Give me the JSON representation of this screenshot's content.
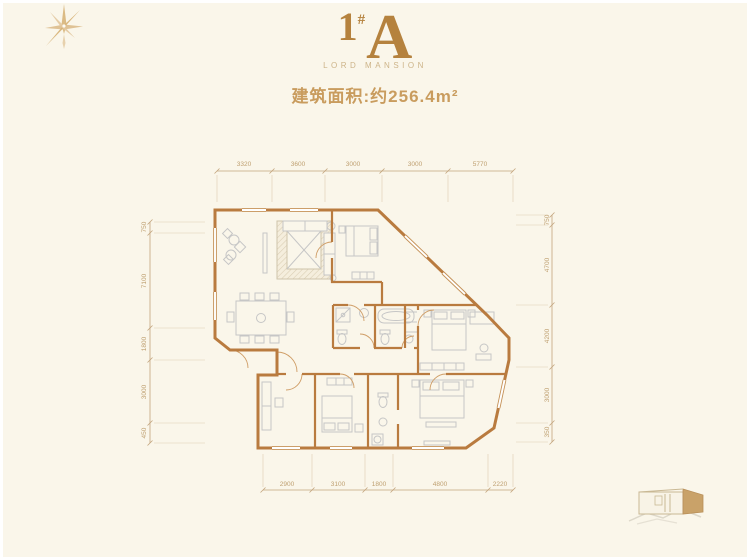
{
  "header": {
    "title_number": "1",
    "title_hash": "#",
    "title_letter": "A",
    "subtitle": "LORD MANSION",
    "area_label": "建筑面积:约256.4m²"
  },
  "floorplan": {
    "dimensions": {
      "top": [
        "3320",
        "3600",
        "3000",
        "3000",
        "5770"
      ],
      "bottom": [
        "2900",
        "3100",
        "1800",
        "4800",
        "2220"
      ],
      "left": [
        "750",
        "7100",
        "1800",
        "3000",
        "450"
      ],
      "right": [
        "750",
        "4700",
        "4200",
        "3000",
        "350"
      ]
    }
  },
  "colors": {
    "background": "#faf6ea",
    "accent": "#b5823e",
    "wall": "#b97b3f",
    "furniture": "#c6c6c6",
    "dimension": "#c2a47c"
  }
}
